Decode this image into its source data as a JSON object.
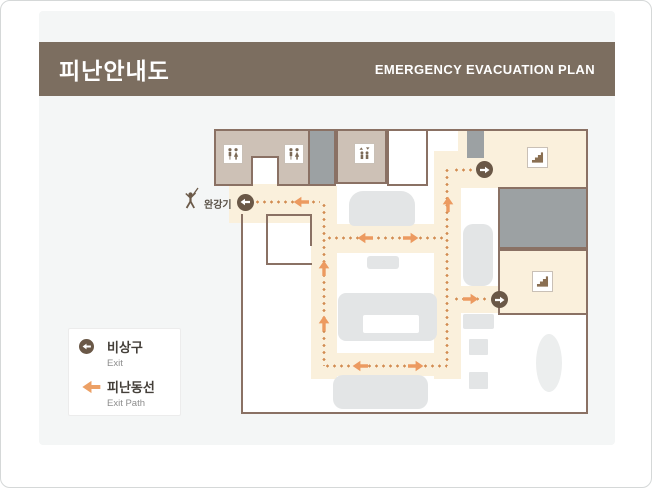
{
  "header": {
    "title": "피난안내도",
    "subtitle": "EMERGENCY EVACUATION PLAN"
  },
  "plan": {
    "descender_label": "완강기"
  },
  "legend": {
    "exit": {
      "label": "비상구",
      "sublabel": "Exit"
    },
    "path": {
      "label": "피난동선",
      "sublabel": "Exit Path"
    }
  },
  "icons": {
    "restroom-icon": "male/female restroom pictogram in white square",
    "elevator-icon": "elevator pictogram (two figures, up/down arrows) in white square",
    "stairs-icon": "staircase pictogram in white square",
    "descender-person-icon": "person using descending life line (완강기)",
    "exit-circle-icon": "dark brown circle with white direction arrow",
    "path-arrow-icon": "orange evacuation direction arrow"
  },
  "palette": {
    "header_brown": "#7c6e60",
    "wall_brown": "#8a7164",
    "room_beige": "#cdc1b6",
    "room_gray": "#9ca1a3",
    "path_cream": "#faf0dc",
    "path_dot_orange": "#d28c52",
    "arrow_orange": "#ec9a60",
    "exit_circle_brown": "#6a5847",
    "furniture_gray": "#e3e5e6",
    "card_bg": "#f4f6f6"
  }
}
